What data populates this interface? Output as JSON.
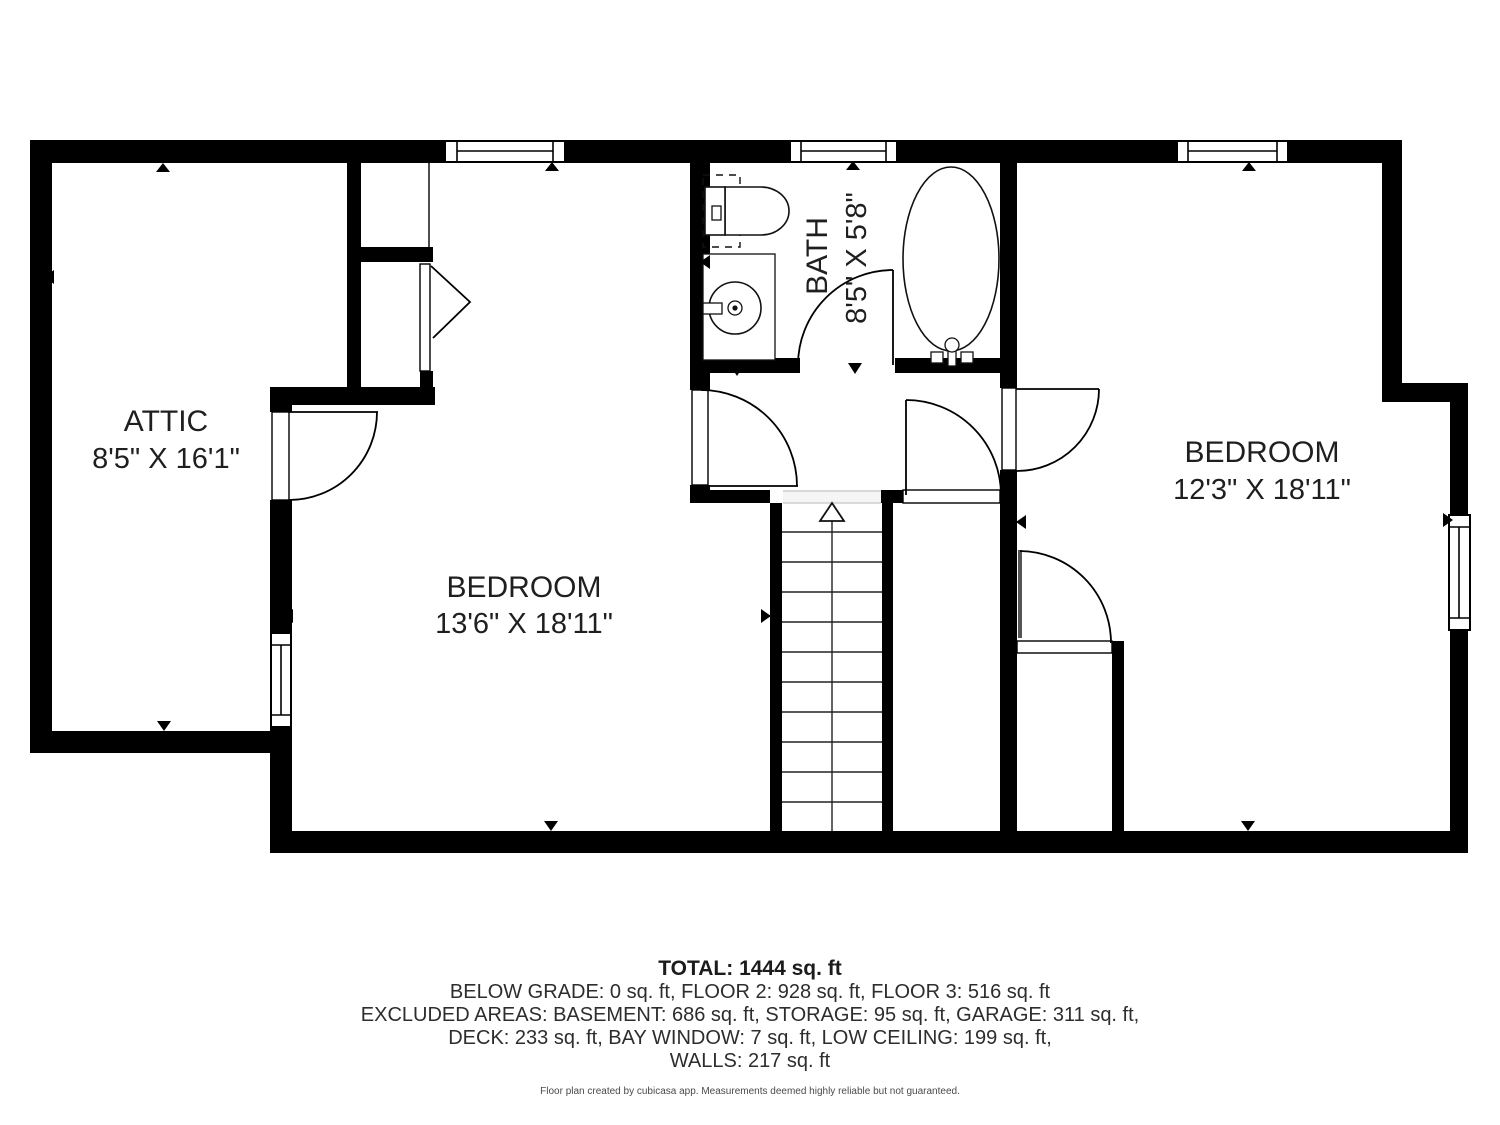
{
  "plan": {
    "rooms": {
      "attic": {
        "name": "ATTIC",
        "dimensions": "8'5\" X 16'1\""
      },
      "bedroom_left": {
        "name": "BEDROOM",
        "dimensions": "13'6\" X 18'11\""
      },
      "bath": {
        "name": "BATH",
        "dimensions": "8'5\" X 5'8\""
      },
      "bedroom_right": {
        "name": "BEDROOM",
        "dimensions": "12'3\" X 18'11\""
      }
    }
  },
  "summary": {
    "total": "TOTAL: 1444 sq. ft",
    "line1": "BELOW GRADE: 0 sq. ft, FLOOR 2: 928 sq. ft, FLOOR 3: 516 sq. ft",
    "line2": "EXCLUDED AREAS: BASEMENT: 686 sq. ft, STORAGE: 95 sq. ft, GARAGE: 311 sq. ft,",
    "line3": "DECK: 233 sq. ft, BAY WINDOW: 7 sq. ft, LOW CEILING: 199 sq. ft,",
    "line4": "WALLS: 217 sq. ft"
  },
  "footer": "Floor plan created by cubicasa app. Measurements deemed highly reliable but not guaranteed.",
  "colors": {
    "wall": "#000000",
    "text": "#2d2d2d"
  }
}
